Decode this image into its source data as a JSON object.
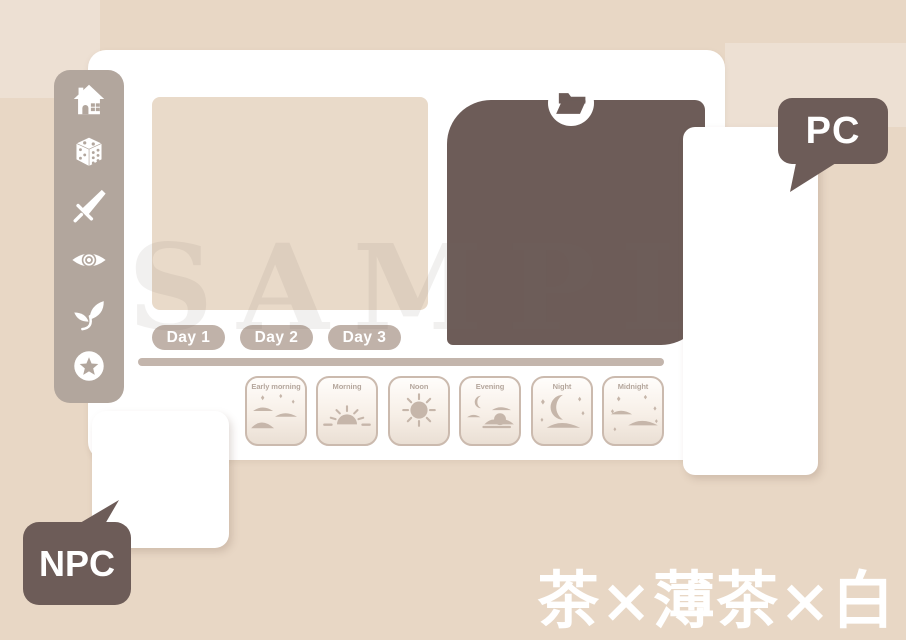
{
  "colors": {
    "background": "#e8d7c5",
    "panel_white": "#ffffff",
    "sidebar_taupe": "#b2a69d",
    "tab_taupe": "#c0b2a9",
    "dark_brown": "#6d5c58",
    "beige_block": "#e9dac9",
    "card_border": "#cbbaae",
    "card_icon": "#c6b6aa"
  },
  "watermark": "SAMPLE",
  "sidebar": {
    "items": [
      {
        "icon": "home"
      },
      {
        "icon": "dice"
      },
      {
        "icon": "sword"
      },
      {
        "icon": "eye"
      },
      {
        "icon": "sprout"
      },
      {
        "icon": "star"
      }
    ]
  },
  "board": {
    "folder_icon": "open-folder",
    "day_tabs": [
      {
        "label": "Day 1"
      },
      {
        "label": "Day 2"
      },
      {
        "label": "Day 3"
      }
    ],
    "time_cards": [
      {
        "label": "Early morning",
        "icon": "early-morning"
      },
      {
        "label": "Morning",
        "icon": "morning-sunrise"
      },
      {
        "label": "Noon",
        "icon": "noon-sun"
      },
      {
        "label": "Evening",
        "icon": "evening-moon-clouds"
      },
      {
        "label": "Night",
        "icon": "night-crescent"
      },
      {
        "label": "Midnight",
        "icon": "midnight-stars"
      }
    ]
  },
  "labels": {
    "pc": "PC",
    "npc": "NPC"
  },
  "caption": {
    "text": "茶×薄茶×白",
    "color": "#ffffff"
  }
}
